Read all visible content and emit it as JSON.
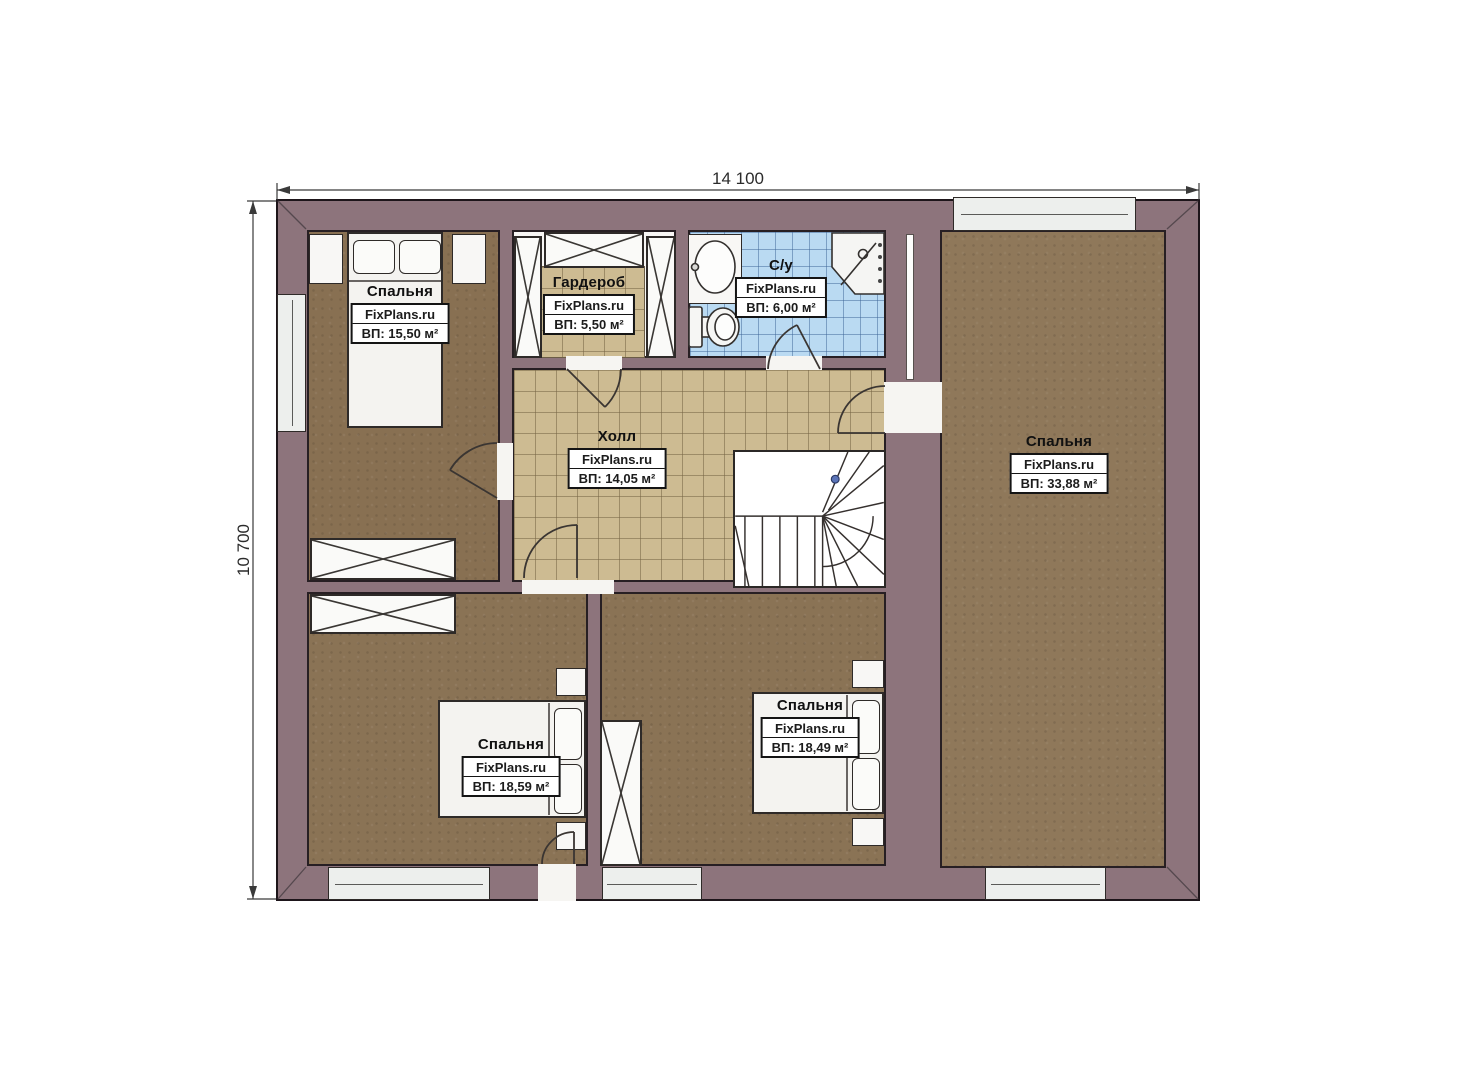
{
  "plan": {
    "title": "Second floor plan",
    "dim_top": "14 100",
    "dim_left": "10 700",
    "watermark": "FixPlans.ru",
    "rooms": [
      {
        "name": "Спальня",
        "area": "ВП: 15,50 м²"
      },
      {
        "name": "Гардероб",
        "area": "ВП: 5,50 м²"
      },
      {
        "name": "С/у",
        "area": "ВП: 6,00 м²"
      },
      {
        "name": "Холл",
        "area": "ВП: 14,05 м²"
      },
      {
        "name": "Спальня",
        "area": "ВП: 33,88 м²"
      },
      {
        "name": "Спальня",
        "area": "ВП: 18,59 м²"
      },
      {
        "name": "Спальня",
        "area": "ВП: 18,49 м²"
      }
    ],
    "colors": {
      "wall": "#8d747c",
      "floor_wood": "#8a7355",
      "floor_wood_right": "#8f785a",
      "floor_tile_hall": "#cdbb92",
      "floor_tile_bath": "#badaf2",
      "stair_post_dot": "#5b74b8",
      "outline": "#1d151a"
    }
  }
}
